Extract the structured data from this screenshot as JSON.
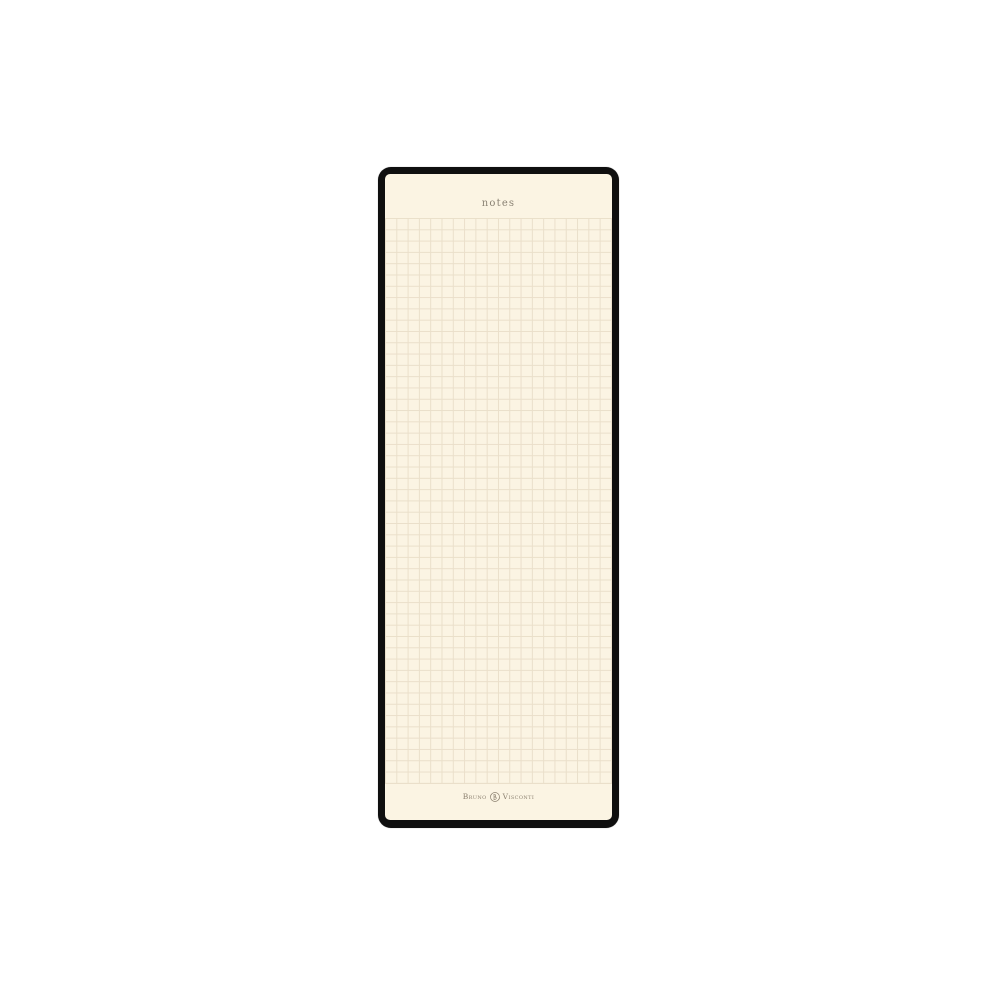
{
  "product": {
    "header_label": "notes",
    "brand": {
      "name_first": "Bruno",
      "name_second": "Visconti",
      "emblem": "bv-monogram"
    },
    "colors": {
      "page_background": "#FFFFFF",
      "frame": "#0F0F0F",
      "paper": "#FBF4E3",
      "grid_line": "#EADFCA",
      "header_text": "#8A8274",
      "brand_text": "#8C8170"
    },
    "grid": {
      "columns": 20,
      "rows": 50
    }
  }
}
